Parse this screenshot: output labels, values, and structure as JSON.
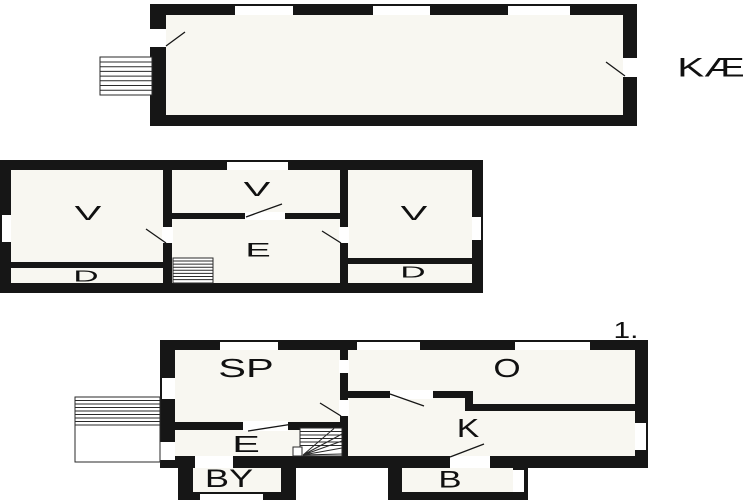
{
  "colors": {
    "background": "#ffffff",
    "wall": "#161616",
    "floor_fill": "#f8f7f1",
    "line": "#2a2a2a"
  },
  "plans": {
    "basement": {
      "label": "KÆ"
    },
    "ground": {
      "room_v_left": "V",
      "room_v_mid": "V",
      "room_v_right": "V",
      "room_e": "E",
      "room_d_left": "D",
      "room_d_right": "D"
    },
    "first": {
      "floor_label": "1.",
      "room_sp": "SP",
      "room_o": "O",
      "room_e": "E",
      "room_k": "K",
      "room_by": "BY",
      "room_b": "B"
    }
  }
}
